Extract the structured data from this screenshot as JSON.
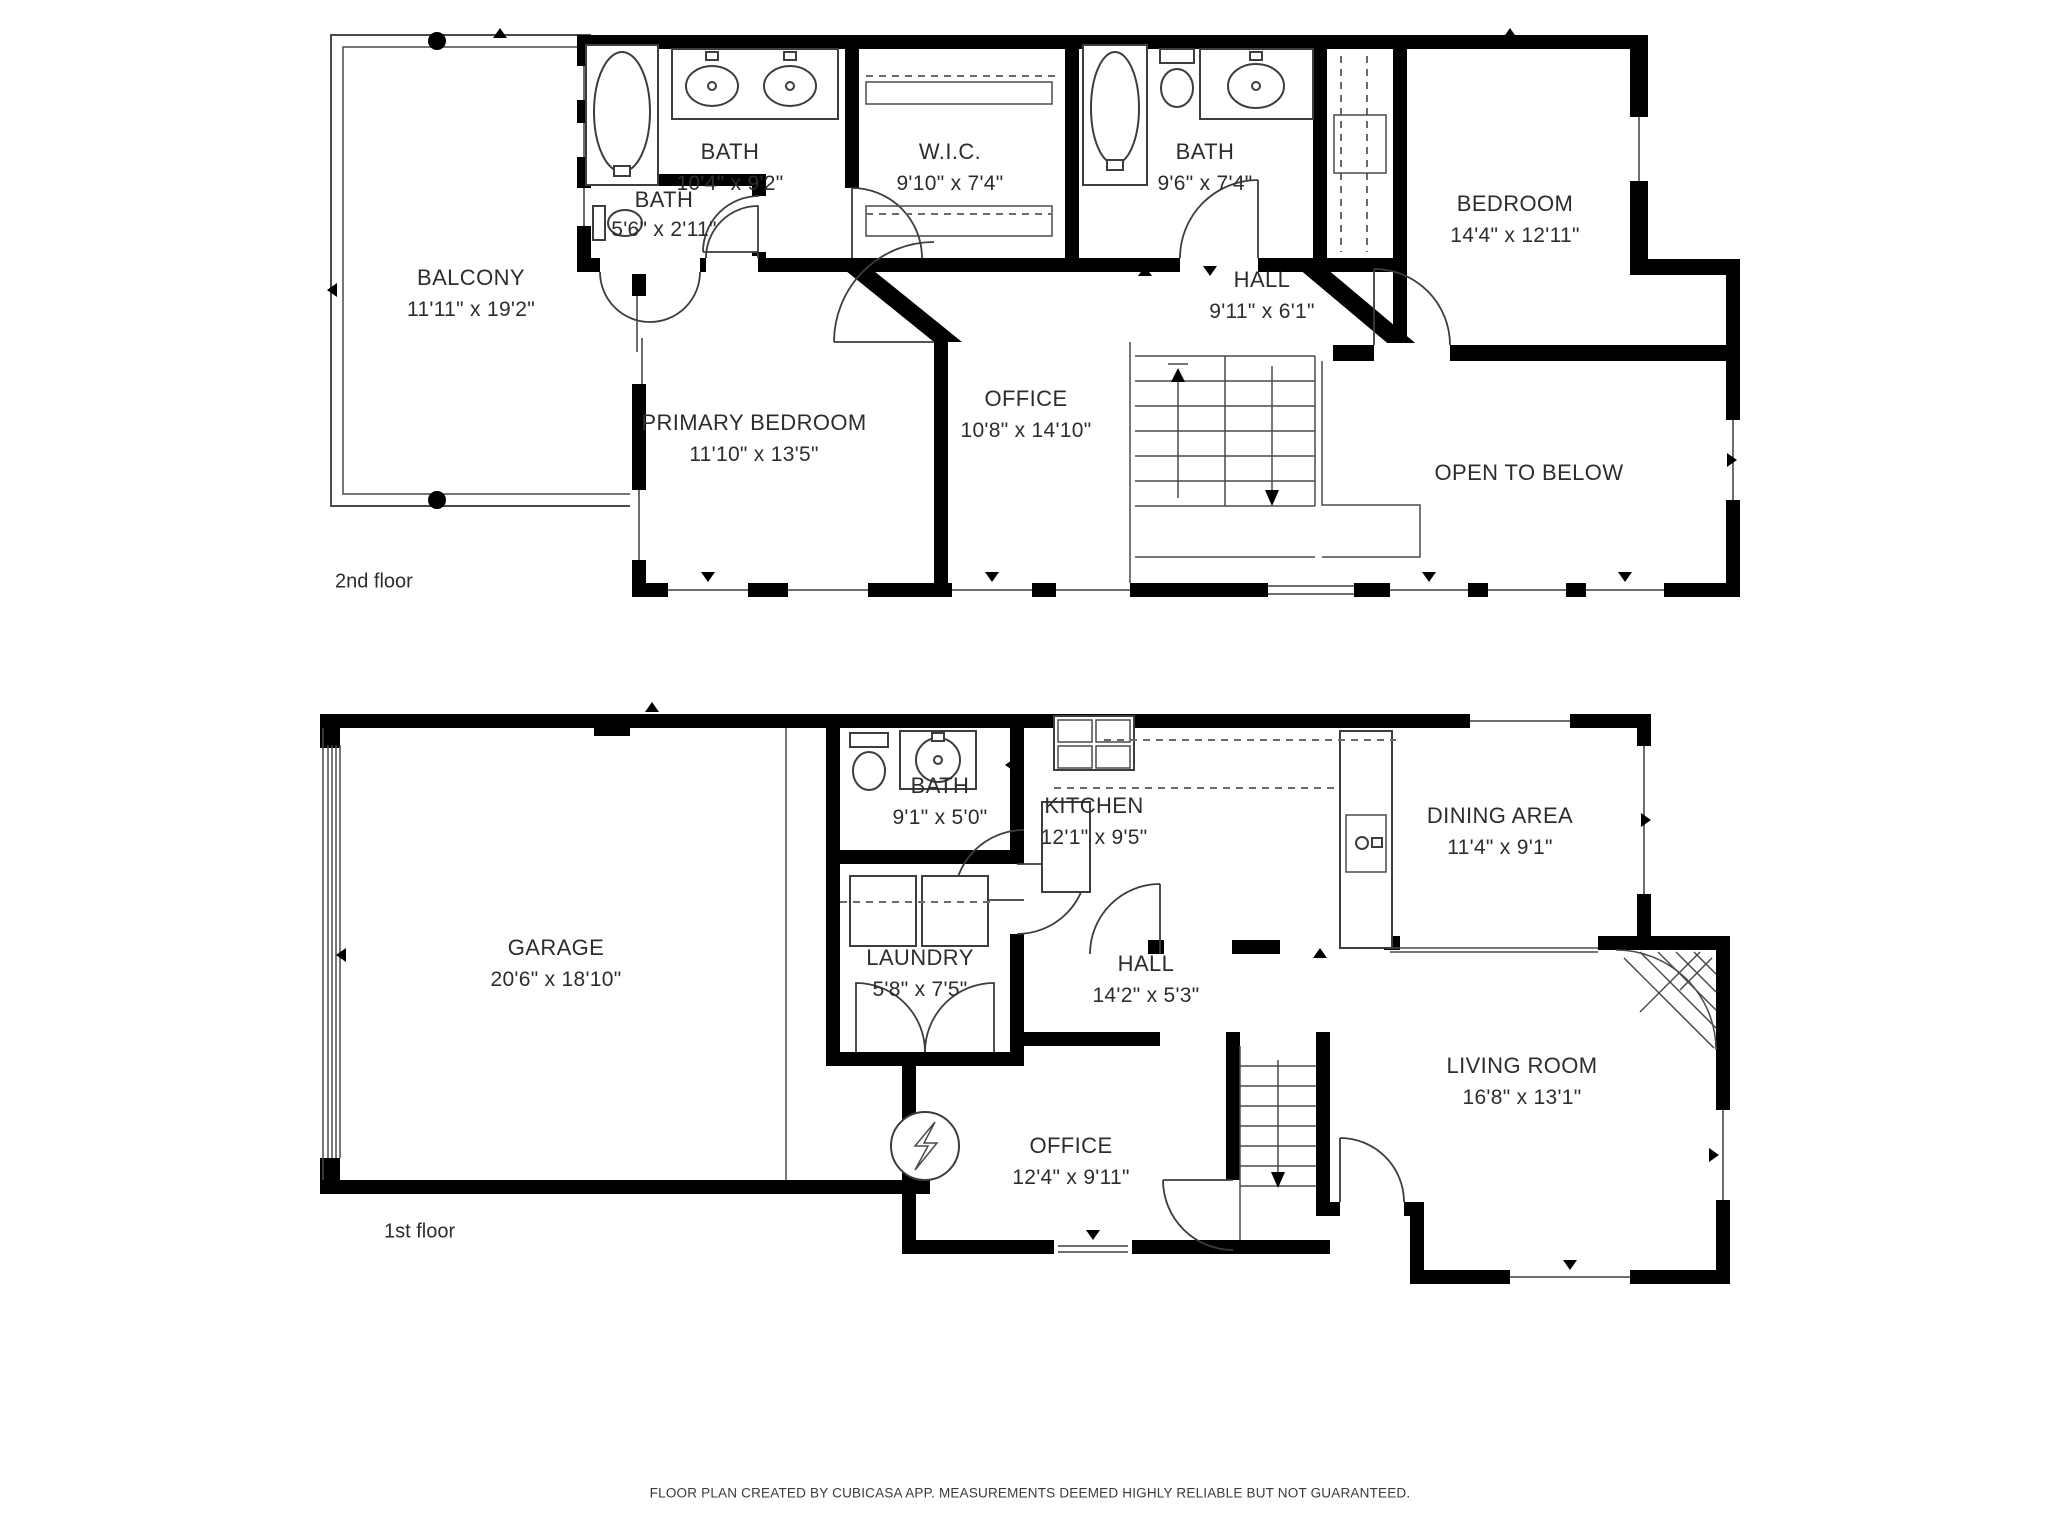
{
  "document_title": "Floor Plan",
  "floors": [
    {
      "label": "2nd floor",
      "rooms": [
        {
          "name": "BALCONY",
          "dims": "11'11\" x 19'2\""
        },
        {
          "name": "BATH",
          "dims": "10'4\" x 9'2\""
        },
        {
          "name": "BATH",
          "dims": "5'6\" x 2'11\""
        },
        {
          "name": "W.I.C.",
          "dims": "9'10\" x 7'4\""
        },
        {
          "name": "BATH",
          "dims": "9'6\" x 7'4\""
        },
        {
          "name": "BEDROOM",
          "dims": "14'4\" x 12'11\""
        },
        {
          "name": "HALL",
          "dims": "9'11\" x 6'1\""
        },
        {
          "name": "PRIMARY BEDROOM",
          "dims": "11'10\" x 13'5\""
        },
        {
          "name": "OFFICE",
          "dims": "10'8\" x 14'10\""
        },
        {
          "name": "OPEN TO BELOW",
          "dims": ""
        }
      ]
    },
    {
      "label": "1st floor",
      "rooms": [
        {
          "name": "GARAGE",
          "dims": "20'6\" x 18'10\""
        },
        {
          "name": "BATH",
          "dims": "9'1\" x 5'0\""
        },
        {
          "name": "LAUNDRY",
          "dims": "5'8\" x 7'5\""
        },
        {
          "name": "KITCHEN",
          "dims": "12'1\" x 9'5\""
        },
        {
          "name": "DINING AREA",
          "dims": "11'4\" x 9'1\""
        },
        {
          "name": "HALL",
          "dims": "14'2\" x 5'3\""
        },
        {
          "name": "OFFICE",
          "dims": "12'4\" x 9'11\""
        },
        {
          "name": "LIVING ROOM",
          "dims": "16'8\" x 13'1\""
        }
      ]
    }
  ],
  "footer": "FLOOR PLAN CREATED BY CUBICASA APP. MEASUREMENTS DEEMED HIGHLY RELIABLE BUT NOT GUARANTEED.",
  "colors": {
    "wall": "#000000",
    "thin_line": "#4a4a4a",
    "text": "#2d2d2d",
    "background": "#ffffff"
  }
}
